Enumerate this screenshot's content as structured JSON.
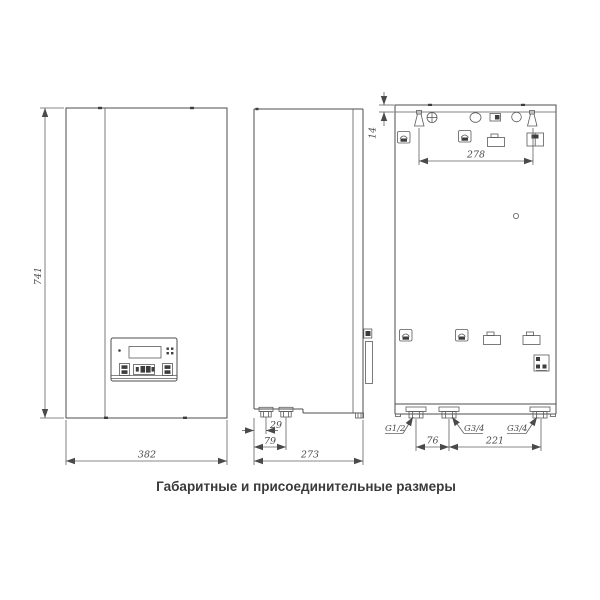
{
  "caption": "Габаритные и присоединительные размеры",
  "front_view": {
    "height_mm": "741",
    "width_mm": "382"
  },
  "side_view": {
    "pipe1_offset_mm": "29",
    "pipe2_offset_mm": "79",
    "depth_mm": "273"
  },
  "rear_view": {
    "top_fold_mm": "14",
    "mount_slot_spacing_mm": "278",
    "pipe_span_left_mm": "76",
    "pipe_span_right_mm": "221",
    "thread_left": "G1/2",
    "thread_middle": "G3/4",
    "thread_right": "G3/4"
  },
  "colors": {
    "line": "#4d4d4d",
    "text": "#4a4a4a",
    "caption": "#3a3a3a"
  }
}
